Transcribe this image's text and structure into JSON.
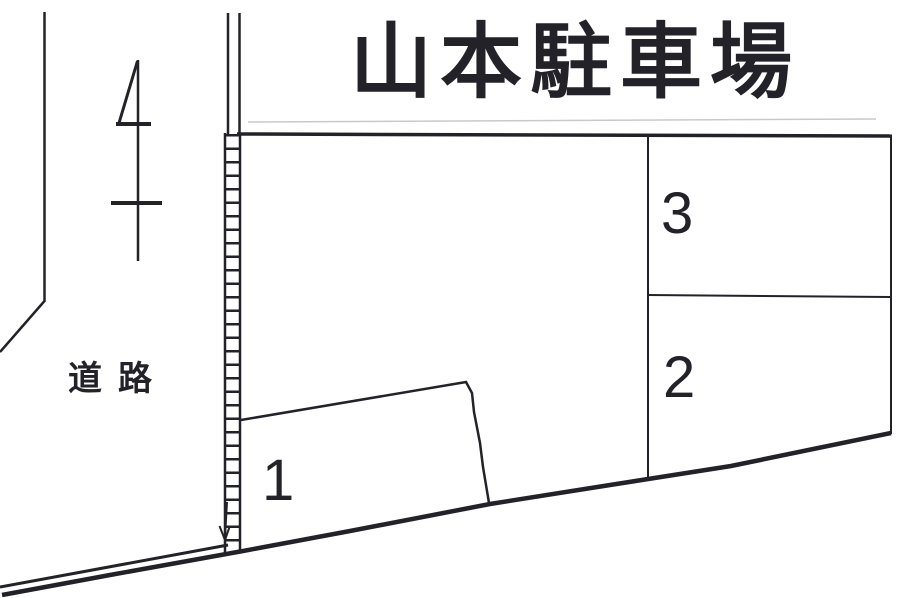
{
  "title": "山本駐車場",
  "road_label": "道路",
  "spaces": [
    {
      "number": "1"
    },
    {
      "number": "2"
    },
    {
      "number": "3"
    }
  ],
  "colors": {
    "ink": "#222228",
    "paper": "#ffffff",
    "faint_line": "#c9c9c9"
  }
}
